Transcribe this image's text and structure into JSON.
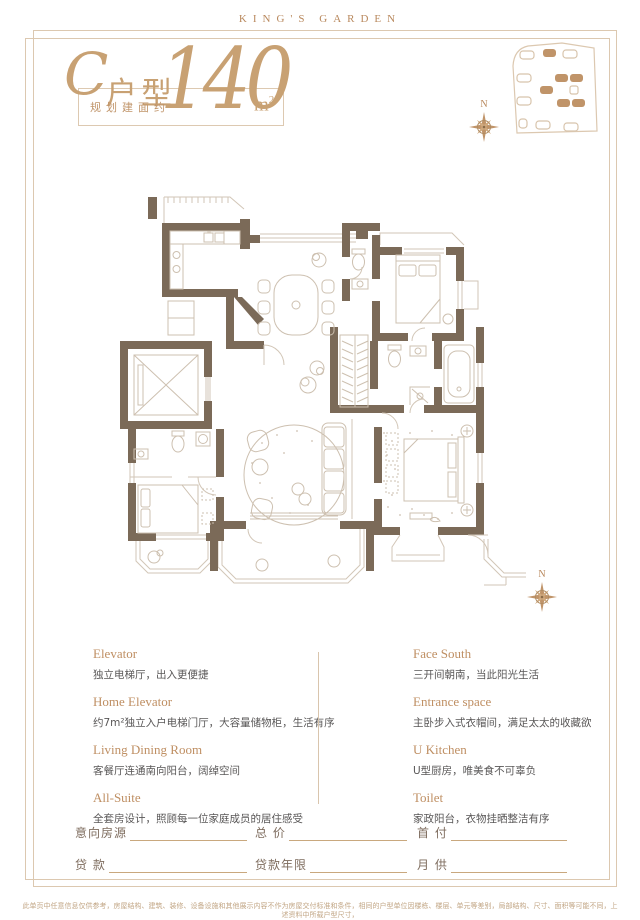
{
  "page": {
    "brand": "KING'S GARDEN"
  },
  "colors": {
    "accent": "#c09469",
    "frame_line": "#dcc8b0",
    "wall": "#7b6a58",
    "plan_line": "#d2c6b7",
    "body_text": "#595757",
    "form_label": "#7e6c5e",
    "disclaimer_text": "#c2a685"
  },
  "title": {
    "unit_prefix": "C",
    "unit_suffix": "户型",
    "area_note": "规划建面约",
    "area_value": "140",
    "area_unit": "m",
    "area_sup": "2"
  },
  "compass": {
    "north_label": "N"
  },
  "icons": [
    "compass-rose-icon",
    "site-plan-map",
    "floor-plan-drawing"
  ],
  "features": {
    "left": [
      {
        "title": "Elevator",
        "desc": "独立电梯厅，出入更便捷"
      },
      {
        "title": "Home Elevator",
        "desc": "约7m²独立入户电梯门厅，大容量储物柜，生活有序"
      },
      {
        "title": "Living Dining Room",
        "desc": "客餐厅连通南向阳台，阔绰空间"
      },
      {
        "title": "All-Suite",
        "desc": "全套房设计，照顾每一位家庭成员的居住感受"
      }
    ],
    "right": [
      {
        "title": "Face South",
        "desc": "三开间朝南，当此阳光生活"
      },
      {
        "title": "Entrance space",
        "desc": "主卧步入式衣帽间，满足太太的收藏欲"
      },
      {
        "title": "U Kitchen",
        "desc": "U型厨房，唯美食不可辜负"
      },
      {
        "title": "Toilet",
        "desc": "家政阳台，衣物挂晒整洁有序"
      }
    ]
  },
  "form": {
    "rows": [
      [
        "意向房源",
        "总 价",
        "首 付"
      ],
      [
        "贷 款",
        "贷款年限",
        "月 供"
      ]
    ]
  },
  "disclaimer": {
    "line1": "此单页中任意信息仅供参考，房屋结构、建筑、装修、设备设施和其他展示内容不作为房屋交付标准和条件，相同的户型单位因楼栋、楼层、单元等差别，局部结构、尺寸、面积等可能不同，上述资料中所载户型尺寸，",
    "line2": "仅为图纸测量，不排除尺寸浮动，所标面积为建筑规划面积；以上内容最终以双方签订的商品房买卖合同约定为准。"
  }
}
